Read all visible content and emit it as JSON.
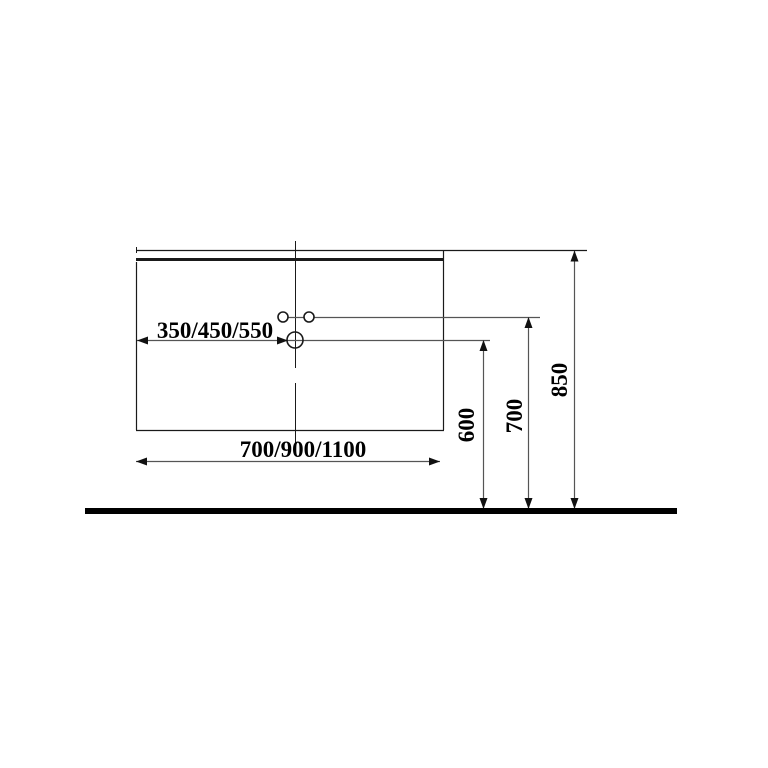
{
  "drawing": {
    "colors": {
      "background": "#ffffff",
      "structure_line": "#1a1a1a",
      "dimension_line": "#555555",
      "text": "#000000",
      "floor_line": "#000000"
    },
    "dimensions": {
      "basin_offset": {
        "label": "350/450/550"
      },
      "cabinet_width": {
        "label": "700/900/1100"
      },
      "hole_height": {
        "label": "600"
      },
      "upper_holes_height": {
        "label": "700"
      },
      "counter_height": {
        "label": "850"
      }
    }
  }
}
